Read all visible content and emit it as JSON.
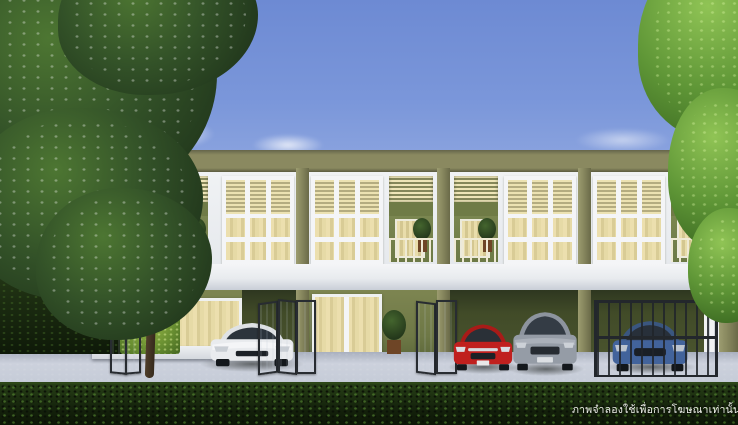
{
  "watermark": {
    "text": "ภาพจำลองใช้เพื่อการโฆษณาเท่านั้น"
  },
  "scene": {
    "type": "architectural rendering",
    "subject": "two-storey modern townhouse row, daytime exterior",
    "building": {
      "storeys": 2,
      "visible_units": 4,
      "features": [
        "cream louver window panels",
        "balconies with potted plants",
        "white floor band",
        "olive green pillars",
        "ground-floor carports",
        "black folding gates"
      ]
    },
    "cars": [
      {
        "name": "white-sedan",
        "color": "#e9ebee"
      },
      {
        "name": "red-sedan",
        "color": "#c0201e"
      },
      {
        "name": "grey-suv",
        "color": "#959ca6"
      },
      {
        "name": "blue-hatchback",
        "color": "#42639b"
      }
    ],
    "palette": {
      "sky_top": "#6d8ad3",
      "sky_horizon": "#dbe1f3",
      "roof_olive": "#8a8960",
      "pillar_olive": "#82825a",
      "wall_white": "#f0f2f4",
      "louver_cream": "#ece2b2",
      "ground_wall_green": "#6e7846",
      "driveway_grey": "#c6ccd8",
      "hedge_green": "#15230c"
    },
    "vegetation": [
      "flowering tree left",
      "bright green tree right",
      "foreground hedge",
      "sunlit shrub",
      "potted plants"
    ]
  }
}
